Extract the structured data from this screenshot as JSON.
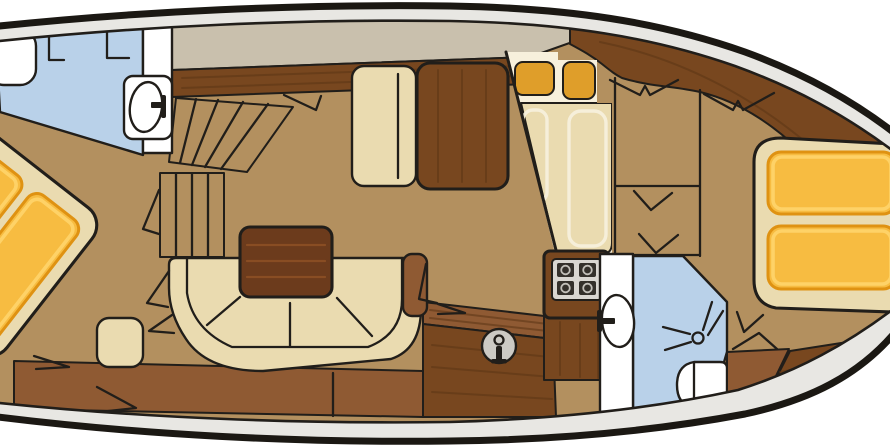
{
  "document": {
    "title": "Motor yacht interior deck floor plan"
  },
  "colors": {
    "background": "#ffffff",
    "line": "#211e1a",
    "hull_outline": "#1b1813",
    "rim": "#e8e7e3",
    "deck": "#c9c0ad",
    "floor": "#b3905f",
    "wood_dark": "#78471f",
    "wood_grain": "#5b3414",
    "wood_mid": "#8f5a33",
    "cream": "#eadbb0",
    "cream_light": "#f7f0dc",
    "table_wood": "#6c3b1c",
    "table_grain": "#935425",
    "orange": "#f7bc41",
    "orange_border": "#df9212",
    "orange_light": "#ffd66e",
    "counter_orange": "#df9e2a",
    "blue": "#b9d1e9",
    "white": "#ffffff",
    "stove_plate": "#d9d6d1",
    "burner": "#34302b",
    "sink_gray": "#cccac4"
  },
  "rooms": [
    {
      "id": "forward-bathroom",
      "fixtures": [
        "toilet",
        "washbasin",
        "vanity",
        "partition"
      ]
    },
    {
      "id": "forward-cabin",
      "fixtures": [
        "double-berth-diagonal",
        "two-mattresses",
        "stool",
        "door-swing"
      ]
    },
    {
      "id": "companionway",
      "fixtures": [
        "fan-steps",
        "straight-steps"
      ]
    },
    {
      "id": "saloon",
      "fixtures": [
        "u-shaped-sofa",
        "dining-table",
        "bench-seat",
        "bench-backrest",
        "armrest",
        "sideboard"
      ]
    },
    {
      "id": "galley",
      "fixtures": [
        "counter-sections",
        "worktop",
        "stove-4-burner",
        "round-sink"
      ]
    },
    {
      "id": "aft-cabin",
      "fixtures": [
        "double-berth",
        "two-mattresses",
        "lockers",
        "door-swings"
      ]
    },
    {
      "id": "aft-bathroom",
      "fixtures": [
        "washbasin",
        "shower-head",
        "toilet"
      ]
    }
  ]
}
